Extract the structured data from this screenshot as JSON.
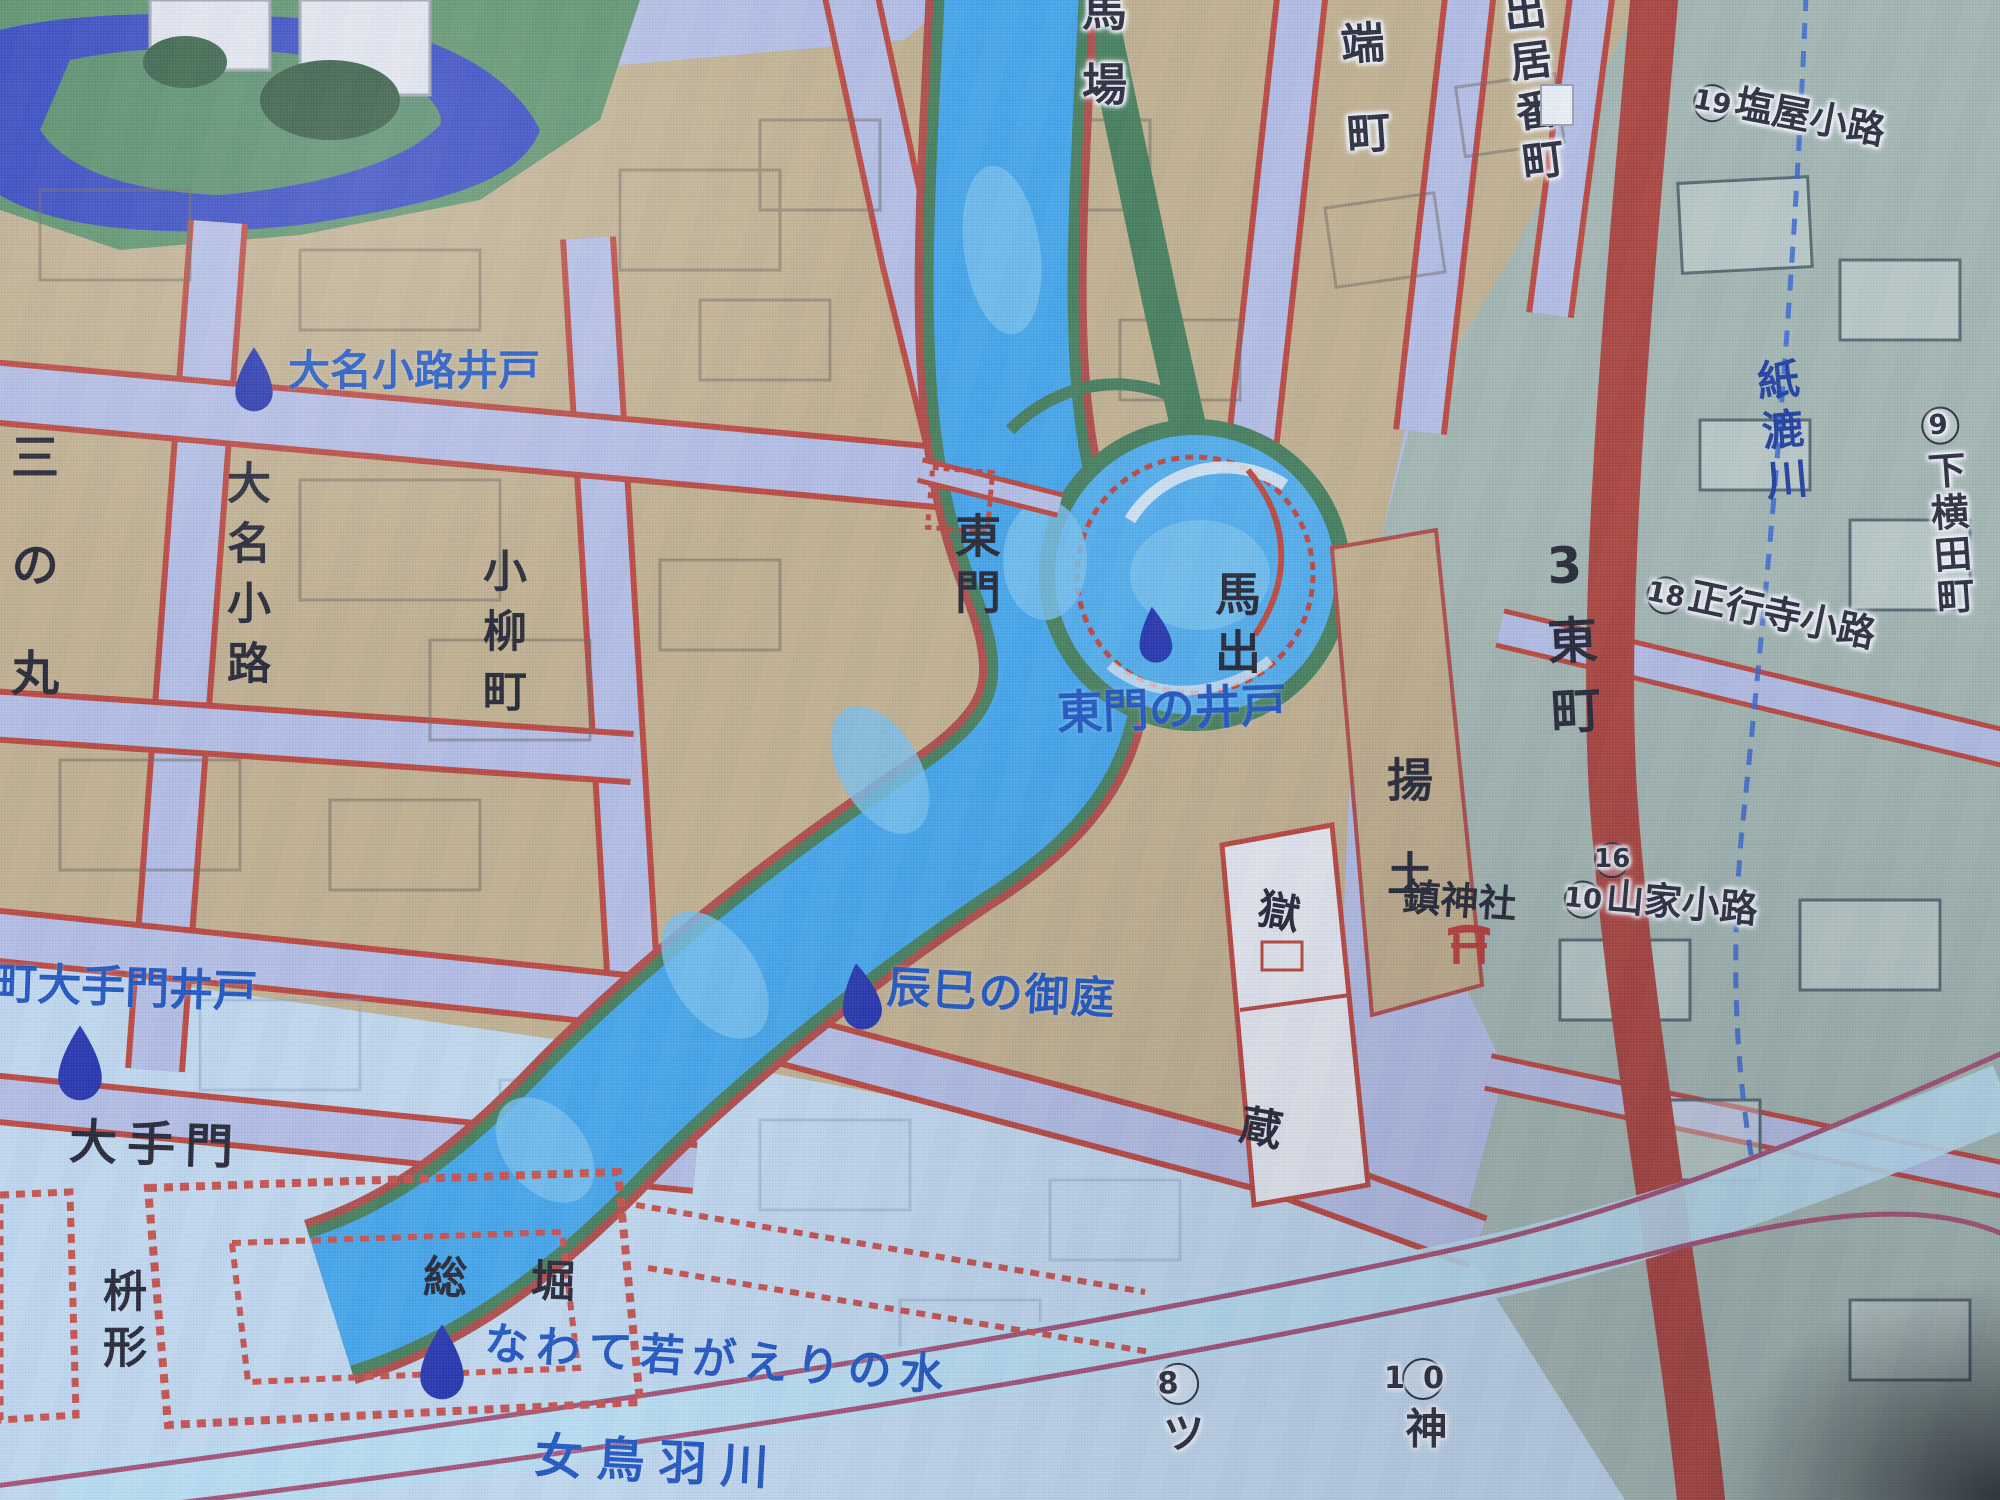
{
  "labels": {
    "sannomaru": {
      "text": "三の丸"
    },
    "daimyo_koji_well": {
      "text": "大名小路井戸"
    },
    "daimyo_koji": {
      "text": "大名小路"
    },
    "koyanagi_cho": {
      "text": "小柳町"
    },
    "baba": {
      "text": "馬場"
    },
    "higashi_mon": {
      "text": "東門"
    },
    "umadashi": {
      "text": "馬出"
    },
    "higashimon_well": {
      "text": "東門の井戸"
    },
    "hashi_machi": {
      "text": "端町"
    },
    "deiban_cho": {
      "text": "出居番町"
    },
    "shioya_koji": {
      "badge": "19",
      "text": "塩屋小路"
    },
    "kamisuki_gawa": {
      "text": "紙漉川"
    },
    "shimo_yokota": {
      "badge": "9",
      "text": "下横田町"
    },
    "shogyoji_koji": {
      "badge": "18",
      "text": "正行寺小路"
    },
    "higashi_machi": {
      "text": "3東町"
    },
    "agetsuchi": {
      "text": "揚土"
    },
    "goku": {
      "text": "獄"
    },
    "kura": {
      "text": "蔵"
    },
    "chin_jinja": {
      "text": "鎮神社"
    },
    "badge_16": {
      "badge": "16"
    },
    "yamaga_koji": {
      "badge": "10",
      "text": "山家小路"
    },
    "tatsumi_no_oniwa": {
      "text": "辰巳の御庭"
    },
    "machi_otemon_well": {
      "text": "町大手門井戸"
    },
    "ote_mon": {
      "text": "大手門"
    },
    "masugata": {
      "text": "枡形"
    },
    "so_bori": {
      "text": "総　堀"
    },
    "nawate_water": {
      "text": "なわて若がえりの水"
    },
    "metoba_gawa": {
      "text": "女鳥羽川"
    },
    "hachi_tsu": {
      "badge": "8",
      "text": "ツ"
    },
    "ju_kami": {
      "badge": "10",
      "text": "神"
    }
  },
  "icons": {
    "well_marker": "water-drop",
    "shrine_marker": "torii-gate"
  },
  "colors": {
    "well_label_blue": "#1550c4",
    "map_text_black": "#1c1c28",
    "flood_blue": "#3aa6ef",
    "moat_dark_blue": "#2b3fc4",
    "road_lavender": "#b6bfe7",
    "road_edge_red": "#c33d31",
    "main_street_red": "#b23b30",
    "block_beige": "#c6b187",
    "castle_green": "#4f8a5e",
    "right_area_teal": "#a4b7ae",
    "pale_flood_blue": "#c3dcf1",
    "river_label_blue": "#16379e",
    "torii_red": "#c23128",
    "drop_icon_blue": "#1c2cb0"
  }
}
